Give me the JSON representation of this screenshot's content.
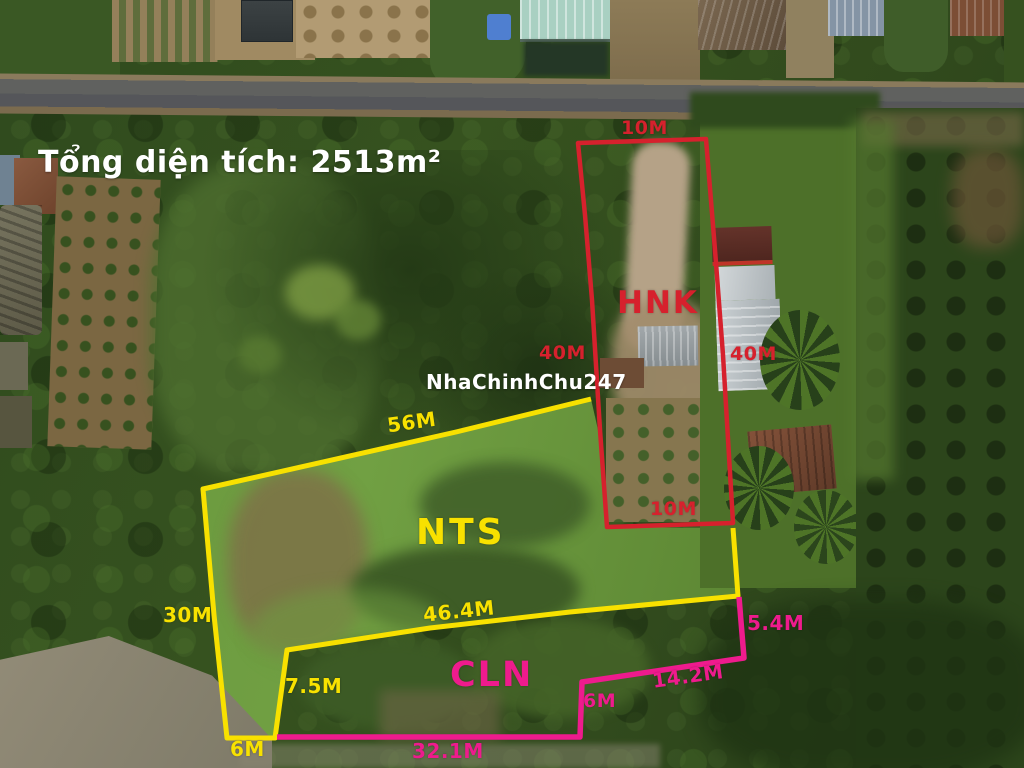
{
  "title": "Tổng diện tích: 2513m²",
  "watermark": "NhaChinhChu247",
  "colors": {
    "hnk_boundary_red": "#d6212d",
    "nts_boundary_yellow": "#f8e100",
    "cln_boundary_pink": "#ee1b8d",
    "title_white": "#ffffff"
  },
  "parcels": {
    "hnk": {
      "name": "HNK",
      "boundary_color": "#d6212d",
      "sides": {
        "top": "10M",
        "left": "40M",
        "right": "40M",
        "bottom": "10M"
      }
    },
    "nts": {
      "name": "NTS",
      "boundary_color": "#f8e100",
      "sides": {
        "top": "56M",
        "left": "30M",
        "bottom": "46.4M",
        "jog_vertical": "7.5M",
        "jog_bottom": "6M"
      }
    },
    "cln": {
      "name": "CLN",
      "boundary_color": "#ee1b8d",
      "sides": {
        "right": "5.4M",
        "diagonal": "14.2M",
        "jog": "6M",
        "bottom": "32.1M"
      }
    }
  }
}
